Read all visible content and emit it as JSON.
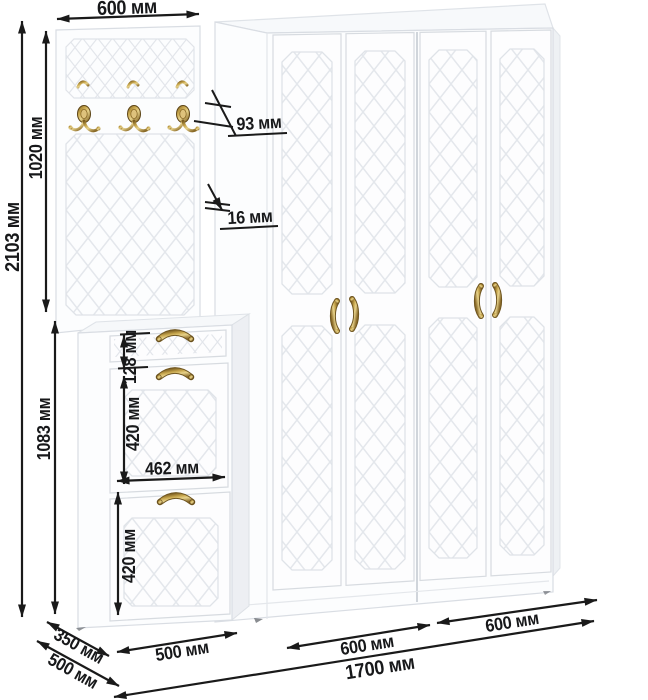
{
  "dims": {
    "panel_width_top": "600 мм",
    "total_height": "2103 мм",
    "hanger_height": "1020 мм",
    "cabinet_height": "1083 мм",
    "hook_offset": "93 мм",
    "panel_thickness": "16 мм",
    "drawer_front_height": "128 мм",
    "upper_door_height": "420 мм",
    "door_width": "462 мм",
    "lower_door_height": "420 мм",
    "cabinet_depth": "350 мм",
    "wardrobe_depth": "500 мм",
    "cabinet_width": "500 мм",
    "wardrobe_section_left_width": "600 мм",
    "wardrobe_section_right_width": "600 мм",
    "total_width": "1700 мм"
  },
  "colors": {
    "dimension_line": "#1a1a1a",
    "brass_accent": "#b3924a",
    "furniture_white": "#fcfdfe"
  }
}
